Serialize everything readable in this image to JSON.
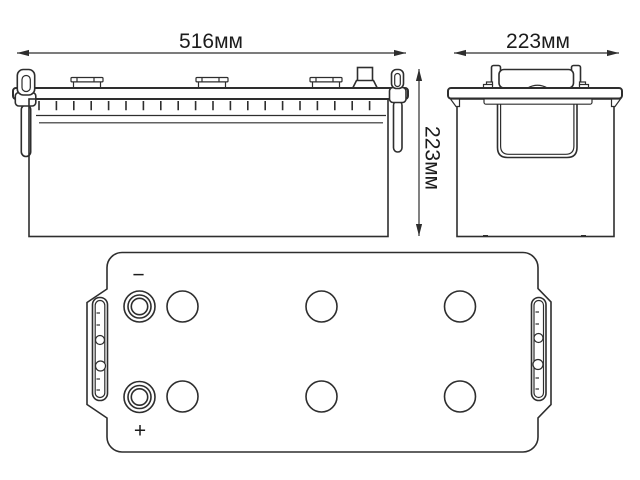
{
  "dimensions": {
    "front_width": "516мм",
    "side_width": "223мм",
    "height": "223мм"
  },
  "top_view": {
    "negative_label": "−",
    "positive_label": "+"
  },
  "colors": {
    "line": "#2e2e2e",
    "background": "#ffffff"
  }
}
